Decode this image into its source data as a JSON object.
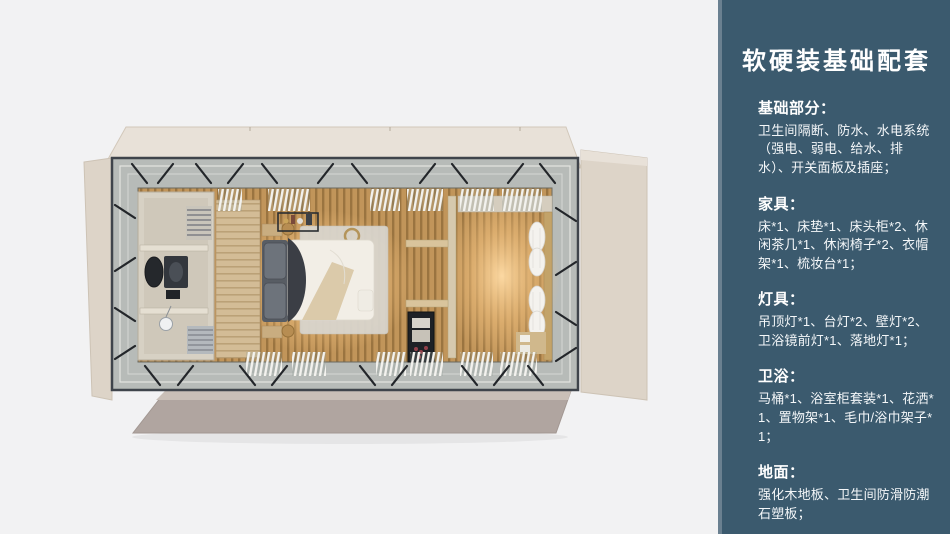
{
  "page": {
    "background": "#f2f2f3"
  },
  "floorplan": {
    "name": "room-top-view-render"
  },
  "panel": {
    "background": "#3b5a6e",
    "edge_strip_color": "#6a8090",
    "text_color": "#ffffff",
    "title": "软硬装基础配套",
    "sections": [
      {
        "heading": "基础部分：",
        "body": "卫生间隔断、防水、水电系统（强电、弱电、给水、排水）、开关面板及插座；"
      },
      {
        "heading": "家具：",
        "body": "床*1、床垫*1、床头柜*2、休闲茶几*1、休闲椅子*2、衣帽架*1、梳妆台*1；"
      },
      {
        "heading": "灯具：",
        "body": "吊顶灯*1、台灯*2、壁灯*2、卫浴镜前灯*1、落地灯*1；"
      },
      {
        "heading": "卫浴：",
        "body": "马桶*1、浴室柜套装*1、花洒*1、置物架*1、毛巾/浴巾架子*1；"
      },
      {
        "heading": "地面：",
        "body": "强化木地板、卫生间防滑防潮石塑板；"
      }
    ]
  },
  "colors": {
    "shell_roof": "#e8e1d8",
    "shell_side": "#ddd4c8",
    "shell_bottom": "#b0a5a0",
    "frame_dark": "#3f444b",
    "walkway_gray": "#b7bbb8",
    "wood_floor": "#c1955a",
    "wood_floor_stripe": "#9a7440",
    "glow_warm": "#ffdca6",
    "bathroom_wall": "#d7d1c4",
    "bed_duvet": "#f2eee6",
    "pillow_gray": "#6d737b",
    "curtain_white": "#f4f2ee"
  }
}
